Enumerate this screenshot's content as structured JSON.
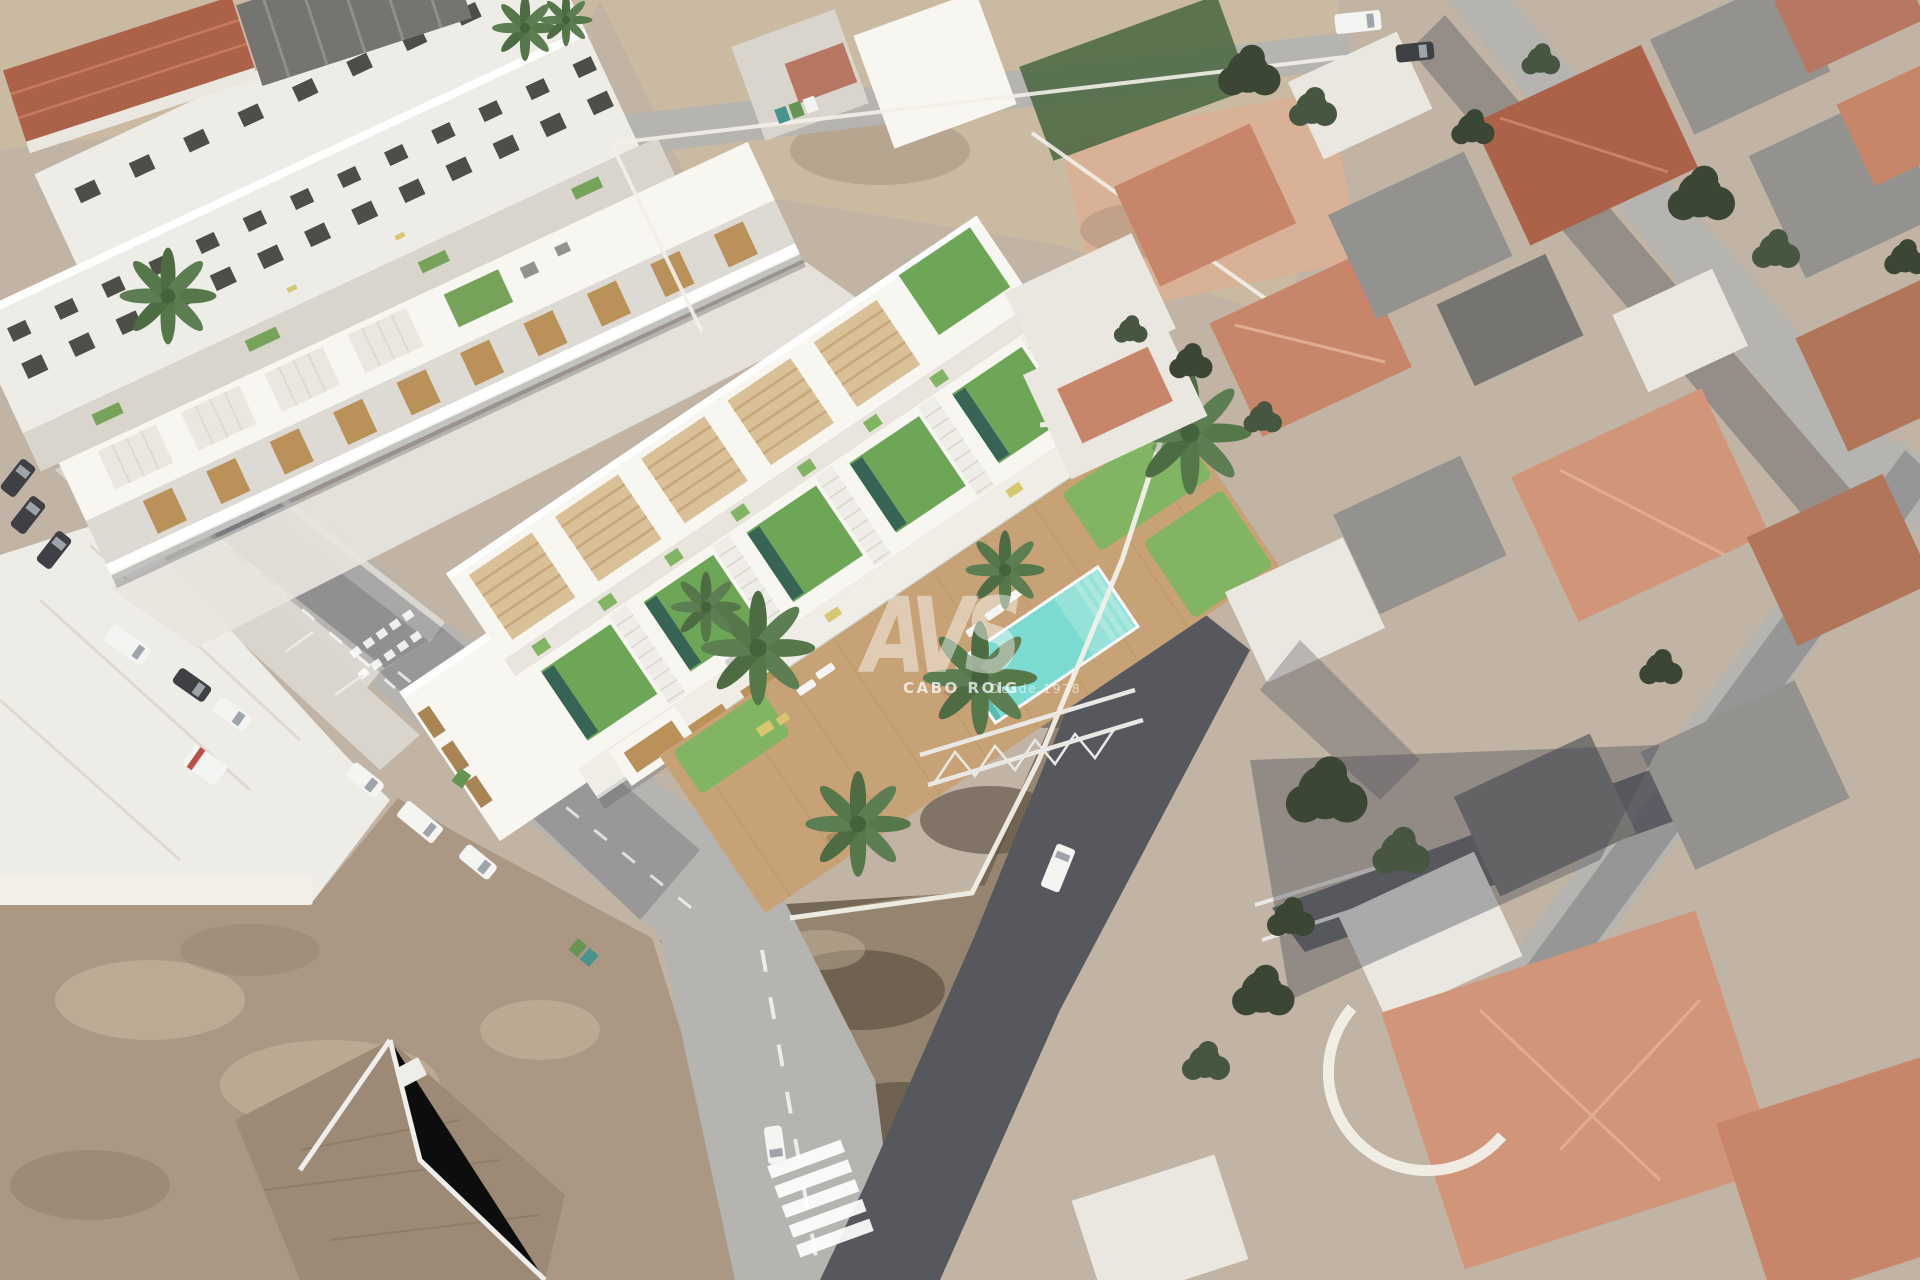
{
  "watermark": {
    "logo_text": "AVS",
    "brand": "CABO ROIG",
    "tagline": "Desde 1978"
  },
  "scene": {
    "type": "aerial-architectural-render",
    "subject": "new white townhouse development with green roofs and communal pool inserted into aerial photo of a town, surrounded by streets, vacant dirt lots and terracotta rooftops"
  },
  "palette": {
    "ground-base": "#beb0a0",
    "dirt-light": "#c9b79e",
    "dirt-mid": "#a6937e",
    "dirt-dark": "#8a7862",
    "scrub": "#6f604d",
    "scrub-blob": "#584a3a",
    "sand-edge": "#cdbb9f",
    "road": "#b2b0ac",
    "road-dark": "#4e4f56",
    "road-mark": "#ffffff",
    "shadow": "#3c3f4a",
    "sidewalk": "#d8d5cf",
    "white-bldg": "#edebe5",
    "white-bright": "#f8f6f1",
    "white-pure": "#ffffff",
    "white-shadow": "#dcd8d1",
    "courtyard": "#d7d3ca",
    "window": "#45453f",
    "wood": "#b88c52",
    "wood-dark": "#a57e4c",
    "pergola": "#d7bd92",
    "pergola-line": "#c2a372",
    "roofslat": "#e9e6df",
    "turf": "#66a24e",
    "turf-dull": "#6f9e52",
    "lawn": "#7cb15b",
    "lap": "#2e5c4c",
    "walkway": "#e8e4dd",
    "stair": "#efede6",
    "stair-line": "#d6d3cb",
    "terrace": "#f0ede6",
    "pool": "#74dace",
    "pool-light": "#a7e7de",
    "pool-dark": "#4fb9ac",
    "deck": "#c59d6f",
    "deck-line": "#b78e60",
    "furniture": "#d5c469",
    "terracotta-1": "#a85a40",
    "terracotta-2": "#c58063",
    "terracotta-3": "#cf9172",
    "terracotta-4": "#ad6f52",
    "terracotta-5": "#b5705a",
    "roof-gray": "#8f8d8a",
    "roof-gray-dark": "#6f6d6a",
    "roof-brown": "#97846f",
    "white-roof": "#e9e6e0",
    "tree": "#3e4d36",
    "tree-dark": "#313d2b",
    "palm": "#4d7040",
    "car-white": "#f4f4f2",
    "car-dark": "#35363a",
    "car-glass": "#9aa0a6",
    "accent-red": "#b8453c",
    "bin-teal": "#3f8f86",
    "bin-green": "#5d8f4a",
    "pink-lot": "#d6ad92",
    "mesh-green": "#49653f",
    "wall-white": "#f2efe8",
    "truss": "#e9e7e3",
    "watermark": "#ffffff"
  }
}
